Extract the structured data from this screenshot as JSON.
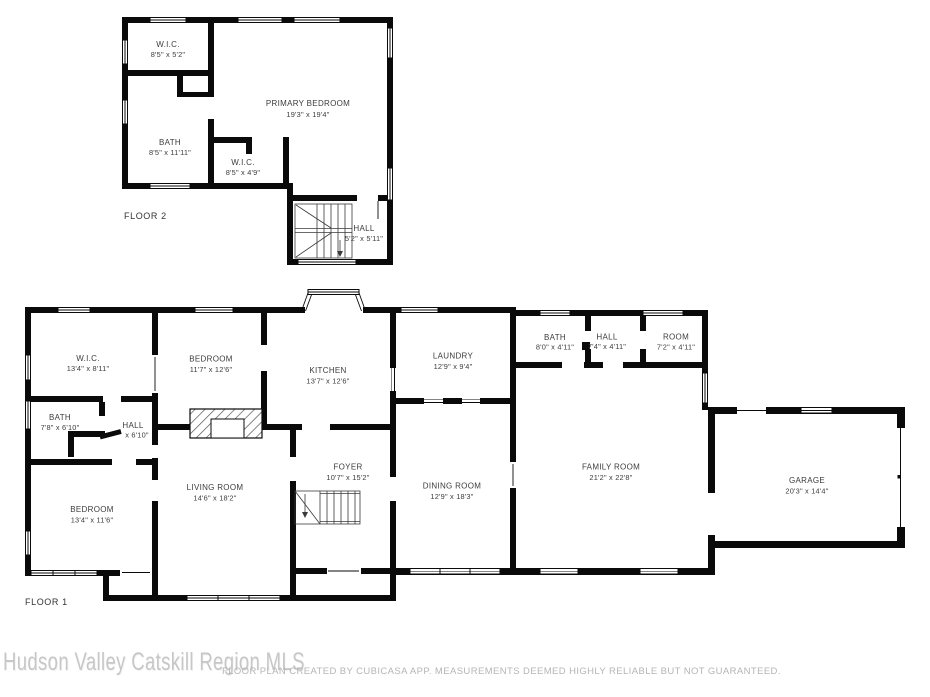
{
  "floors": [
    {
      "label": "FLOOR 2",
      "rooms": [
        {
          "name": "W.I.C.",
          "dims": "8'5\" x 5'2\""
        },
        {
          "name": "BATH",
          "dims": "8'5\" x 11'11\""
        },
        {
          "name": "PRIMARY BEDROOM",
          "dims": "19'3\" x 19'4\""
        },
        {
          "name": "W.I.C.",
          "dims": "8'5\" x 4'9\""
        },
        {
          "name": "HALL",
          "dims": "5'2\" x 5'11\""
        }
      ]
    },
    {
      "label": "FLOOR 1",
      "rooms": [
        {
          "name": "W.I.C.",
          "dims": "13'4\" x 8'11\""
        },
        {
          "name": "BATH",
          "dims": "7'8\" x 6'10\""
        },
        {
          "name": "HALL",
          "dims": "x 6'10\""
        },
        {
          "name": "BEDROOM",
          "dims": "13'4\" x 11'6\""
        },
        {
          "name": "BEDROOM",
          "dims": "11'7\" x 12'6\""
        },
        {
          "name": "LIVING ROOM",
          "dims": "14'6\" x 18'2\""
        },
        {
          "name": "KITCHEN",
          "dims": "13'7\" x 12'6\""
        },
        {
          "name": "FOYER",
          "dims": "10'7\" x 15'2\""
        },
        {
          "name": "LAUNDRY",
          "dims": "12'9\" x 9'4\""
        },
        {
          "name": "DINING ROOM",
          "dims": "12'9\" x 18'3\""
        },
        {
          "name": "BATH",
          "dims": "8'0\" x 4'11\""
        },
        {
          "name": "HALL",
          "dims": "7'4\" x 4'11\""
        },
        {
          "name": "ROOM",
          "dims": "7'2\" x 4'11\""
        },
        {
          "name": "FAMILY ROOM",
          "dims": "21'2\" x 22'8\""
        },
        {
          "name": "GARAGE",
          "dims": "20'3\" x 14'4\""
        }
      ]
    }
  ],
  "footer": {
    "watermark": "Hudson Valley Catskill Region MLS",
    "disclaimer": "FLOOR PLAN CREATED BY CUBICASA APP. MEASUREMENTS DEEMED HIGHLY RELIABLE BUT NOT GUARANTEED."
  },
  "colors": {
    "walls": "#0a0a0a",
    "background": "#ffffff",
    "labels": "#3c3c3c",
    "watermark": "#c7c7c7",
    "disclaimer": "#b5b5b5"
  }
}
